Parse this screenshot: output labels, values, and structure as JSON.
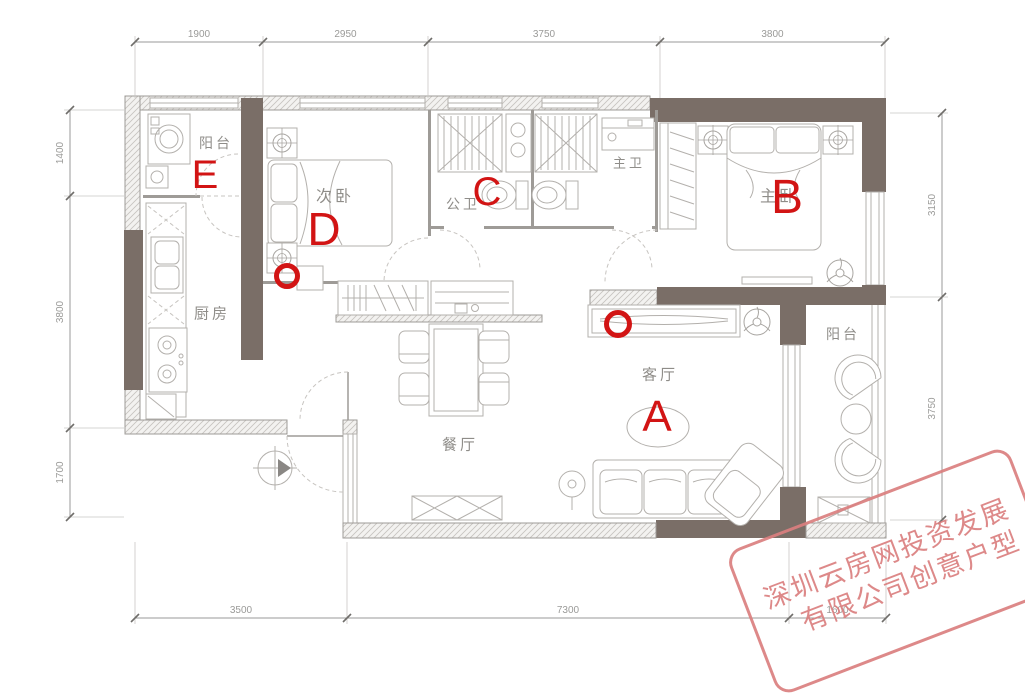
{
  "meta": {
    "type": "apartment-floor-plan"
  },
  "colors": {
    "wall_dark": "#7a6e67",
    "annotation_red": "#d21414",
    "watermark_pink": "#db7f7f",
    "label_gray": "#8f8d89"
  },
  "rooms": [
    {
      "id": "balcony-top",
      "label": "阳台",
      "x": 216,
      "y": 143,
      "size": 14
    },
    {
      "id": "second-bedroom",
      "label": "次卧",
      "x": 335,
      "y": 197,
      "size": 16
    },
    {
      "id": "public-bath",
      "label": "公卫",
      "x": 463,
      "y": 204,
      "size": 14
    },
    {
      "id": "master-bath",
      "label": "主卫",
      "x": 629,
      "y": 163,
      "size": 13
    },
    {
      "id": "master-bedroom",
      "label": "主卧",
      "x": 779,
      "y": 197,
      "size": 16
    },
    {
      "id": "kitchen",
      "label": "厨房",
      "x": 212,
      "y": 314,
      "size": 15
    },
    {
      "id": "living-room",
      "label": "客厅",
      "x": 660,
      "y": 375,
      "size": 15
    },
    {
      "id": "dining-room",
      "label": "餐厅",
      "x": 460,
      "y": 445,
      "size": 15
    },
    {
      "id": "balcony-right",
      "label": "阳台",
      "x": 843,
      "y": 334,
      "size": 14
    }
  ],
  "dimensions": {
    "top": {
      "orientation": "h",
      "line_pos": 42,
      "ticks": [
        135,
        263,
        428,
        660,
        885
      ],
      "labels": [
        "1900",
        "2950",
        "3750",
        "3800"
      ],
      "ext": [
        -6,
        56
      ]
    },
    "bottom": {
      "orientation": "h",
      "line_pos": 618,
      "ticks": [
        135,
        347,
        789,
        886
      ],
      "labels": [
        "3500",
        "7300",
        "1600"
      ],
      "ext": [
        6,
        -76
      ]
    },
    "left": {
      "orientation": "v",
      "line_pos": 70,
      "ticks": [
        110,
        196,
        428,
        517
      ],
      "labels": [
        "1400",
        "3800",
        "1700"
      ],
      "ext": [
        -6,
        54
      ]
    },
    "right": {
      "orientation": "v",
      "line_pos": 942,
      "ticks": [
        113,
        297,
        520
      ],
      "labels": [
        "3150",
        "3750"
      ],
      "ext": [
        6,
        -52
      ]
    }
  },
  "annotations": {
    "letters": [
      {
        "label": "A",
        "x": 657,
        "y": 431,
        "size": 44
      },
      {
        "label": "B",
        "x": 787,
        "y": 213,
        "size": 48
      },
      {
        "label": "C",
        "x": 487,
        "y": 205,
        "size": 40
      },
      {
        "label": "D",
        "x": 324,
        "y": 245,
        "size": 46
      },
      {
        "label": "E",
        "x": 205,
        "y": 188,
        "size": 40
      }
    ],
    "circles": [
      {
        "x": 287,
        "y": 276,
        "r": 10.5
      },
      {
        "x": 618,
        "y": 324,
        "r": 11.5
      }
    ]
  },
  "watermark": {
    "line1": "深圳云房网投资发展",
    "line2": "有限公司创意户型"
  }
}
